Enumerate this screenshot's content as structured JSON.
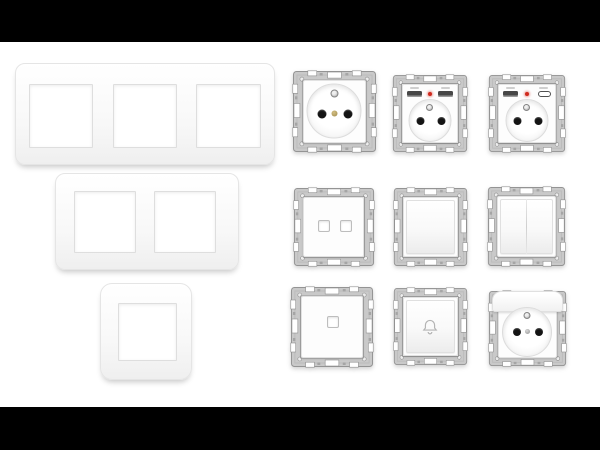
{
  "scene": {
    "description": "Product photo of a white modular wall-plate system: three faceplate frames and nine mechanism modules on metal claw frames",
    "background_color": "#ffffff",
    "letterbox_color": "#000000",
    "letterbox_top_height": 42,
    "letterbox_bottom_height": 43
  },
  "palette": {
    "plate_white": "#fdfdfd",
    "plate_edge": "#e5e5e5",
    "metal_frame": "#c9c9c9",
    "metal_frame_dark": "#949494",
    "socket_hole": "#141414",
    "earth_pin": "#a3a3a3",
    "led_red": "#d02a1e",
    "usb_port_dark": "#474747",
    "screw_gold": "#a08b4c",
    "screw_grey": "#8f8f8f"
  },
  "faceplates": [
    {
      "label": "Triple-gang faceplate frame",
      "gangs": 3
    },
    {
      "label": "Double-gang faceplate frame",
      "gangs": 2
    },
    {
      "label": "Single-gang faceplate frame",
      "gangs": 1
    }
  ],
  "modules": [
    {
      "label": "French socket 2P+E with earth pin",
      "row": 1,
      "col": 1
    },
    {
      "label": "Socket with two USB-A charging ports and red LED",
      "row": 1,
      "col": 2
    },
    {
      "label": "Socket with USB-A and USB-C charging ports and red LED",
      "row": 1,
      "col": 3
    },
    {
      "label": "Double data outlet",
      "row": 2,
      "col": 1
    },
    {
      "label": "Single rocker switch",
      "row": 2,
      "col": 2
    },
    {
      "label": "Double rocker switch",
      "row": 2,
      "col": 3
    },
    {
      "label": "Single data outlet",
      "row": 3,
      "col": 1
    },
    {
      "label": "Bell push button",
      "row": 3,
      "col": 2
    },
    {
      "label": "French socket 2P+E with hinged cover flap",
      "row": 3,
      "col": 3
    }
  ]
}
